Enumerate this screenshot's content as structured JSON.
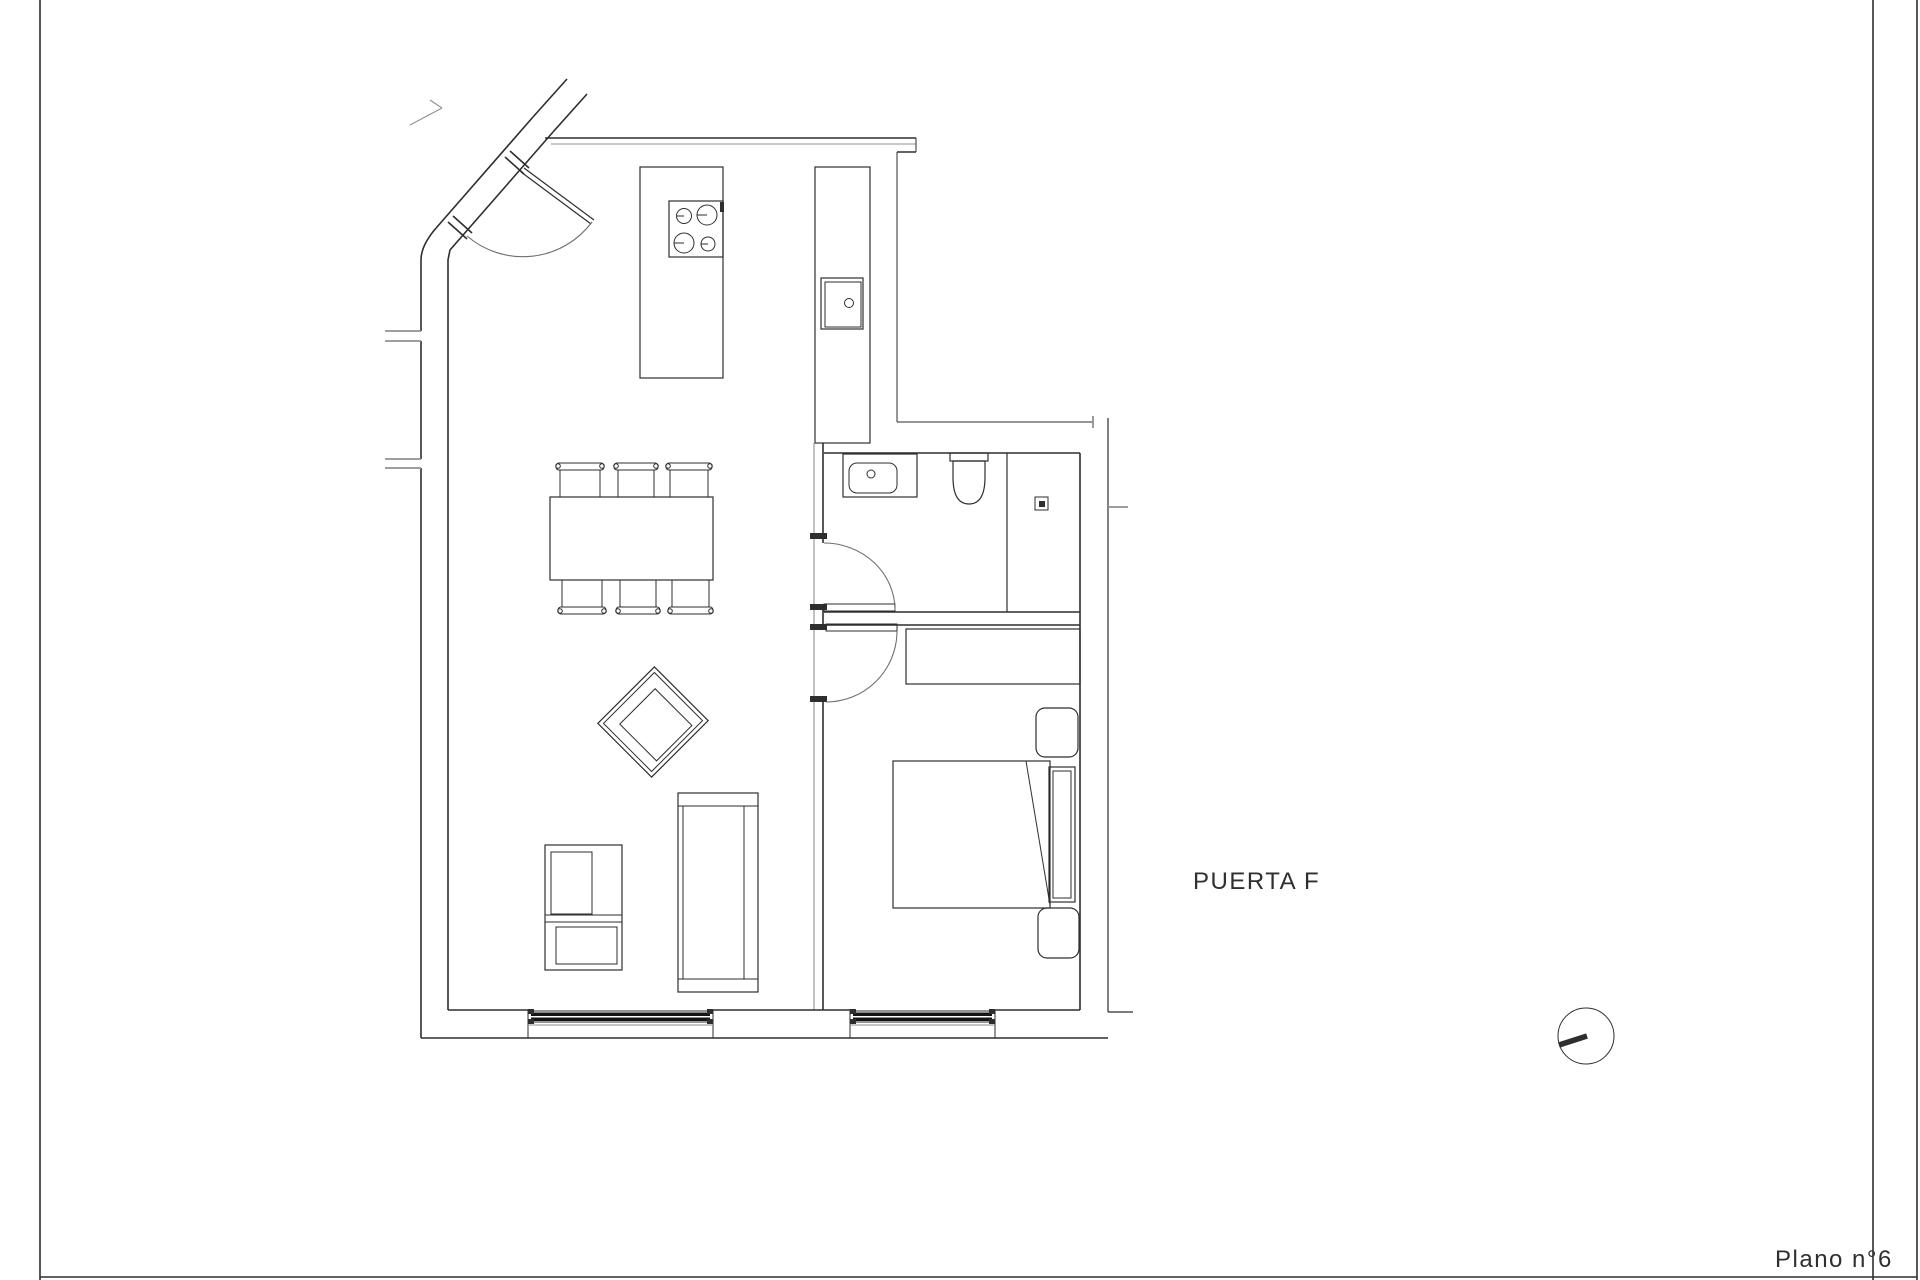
{
  "labels": {
    "door_label": "PUERTA F",
    "plan_number_label": "Plano n°6"
  },
  "colors": {
    "bg": "#ffffff",
    "line": "#2e2e2e",
    "gray": "#909090",
    "light": "#6f6f6f",
    "winfill": "#141414",
    "text": "#2f2f2f"
  },
  "fixtures": [
    "entrance-door",
    "kitchen-island",
    "cooktop-4-burners",
    "kitchen-counter",
    "kitchen-sink",
    "dining-table",
    "dining-chairs-x6",
    "armchair",
    "sofa",
    "tv-cabinet",
    "bathroom-vanity-sink",
    "toilet",
    "shower-with-drain",
    "bathroom-door",
    "bedroom-door",
    "wardrobe",
    "double-bed",
    "nightstand-x2",
    "window-living-room",
    "window-bedroom",
    "orientation-marker"
  ]
}
